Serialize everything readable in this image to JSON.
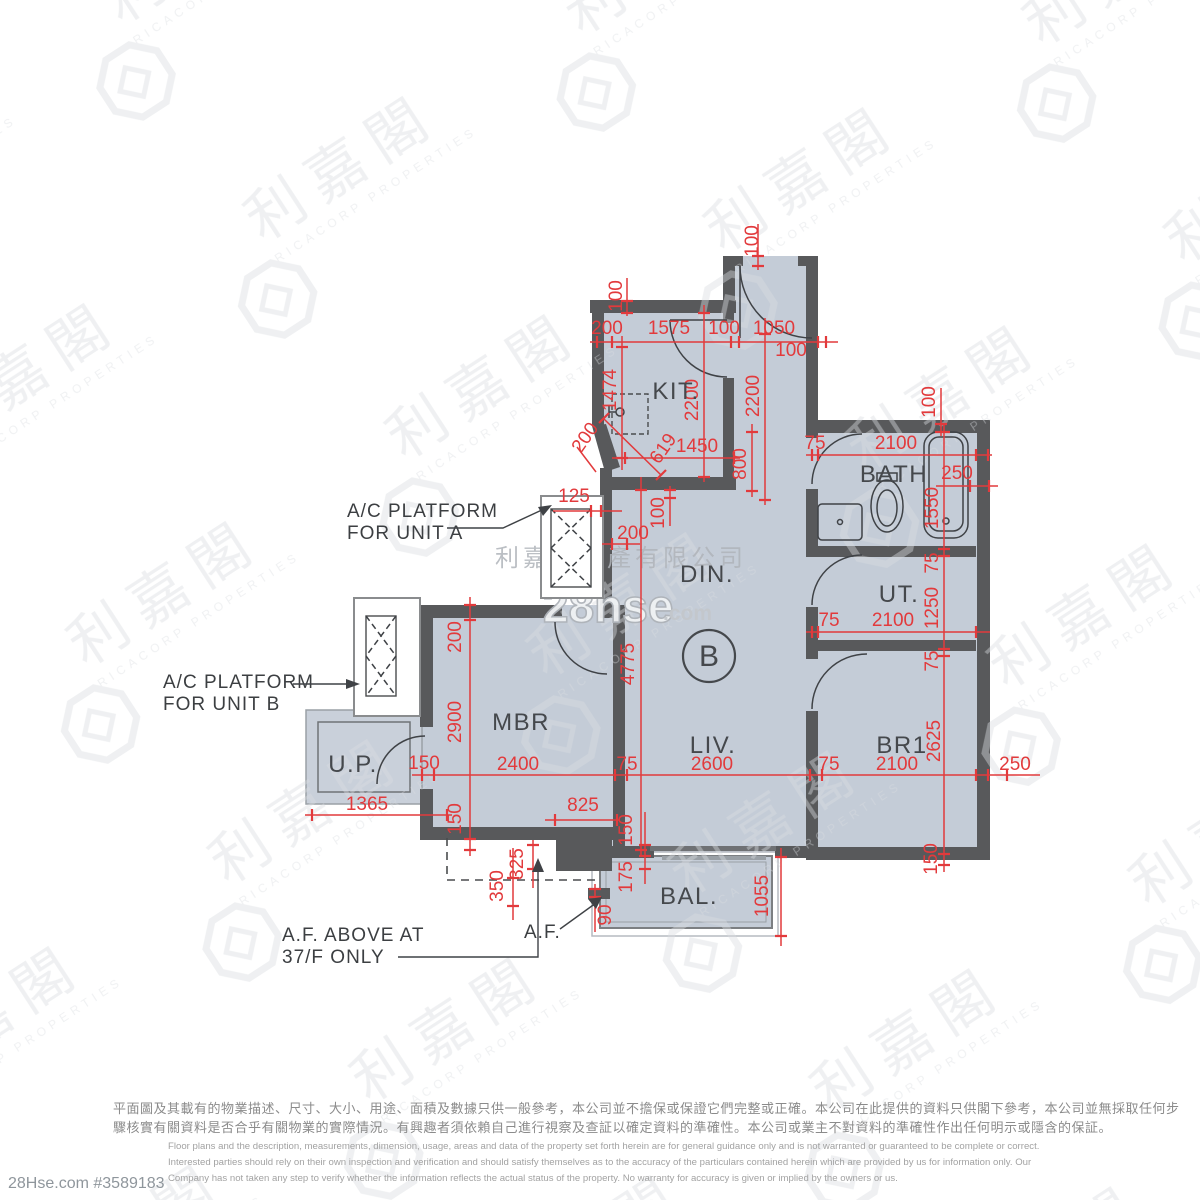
{
  "watermark": {
    "brand_cn": "利嘉閣",
    "brand_en": "RICACORP PROPERTIES",
    "company_cn": "利嘉閣地產有限公司",
    "hse_main": "28hse",
    "hse_suffix": ".com",
    "listing_ref": "28Hse.com #3589183"
  },
  "plan": {
    "unit": "B",
    "rooms": {
      "kit": "KIT.",
      "bath": "BATH",
      "din": "DIN.",
      "ut": "UT.",
      "mbr": "MBR",
      "liv": "LIV.",
      "br1": "BR1",
      "up": "U.P.",
      "bal": "BAL."
    },
    "annotations": {
      "ac_a_line1": "A/C PLATFORM",
      "ac_a_line2": "FOR UNIT A",
      "ac_b_line1": "A/C PLATFORM",
      "ac_b_line2": "FOR UNIT B",
      "af_above_line1": "A.F. ABOVE AT",
      "af_above_line2": "37/F ONLY",
      "af": "A.F."
    },
    "dims": {
      "d01": "100",
      "d02": "100",
      "d03": "200",
      "d04": "1575",
      "d05": "100",
      "d06": "1050",
      "d07": "100",
      "d08": "1474",
      "d09": "2200",
      "d10": "2200",
      "d11": "800",
      "d12": "619",
      "d13": "1450",
      "d14": "200",
      "d15": "125",
      "d16": "200",
      "d17": "100",
      "d18": "75",
      "d19": "2100",
      "d20": "100",
      "d21": "250",
      "d22": "1550",
      "d23": "75",
      "d24": "1250",
      "d25": "75",
      "d26": "75",
      "d27": "2100",
      "d28": "4775",
      "d29": "200",
      "d30": "2900",
      "d31": "2625",
      "d32": "150",
      "d33": "2400",
      "d34": "75",
      "d35": "2600",
      "d36": "75",
      "d37": "2100",
      "d38": "250",
      "d39": "1365",
      "d40": "150",
      "d41": "825",
      "d42": "150",
      "d43": "175",
      "d44": "325",
      "d45": "350",
      "d46": "90",
      "d47": "1055",
      "d48": "150"
    }
  },
  "disclaimer": {
    "zh1": "平面圖及其載有的物業描述、尺寸、大小、用途、面積及數據只供一般參考，本公司並不擔保或保證它們完整或正確。本公司在此提供的資料只供閣下參考，本公司並無採取任何步",
    "zh2": "驟核實有關資料是否合乎有關物業的實際情況。有興趣者須依賴自己進行視察及查証以確定資料的準確性。本公司或業主不對資料的準確性作出任何明示或隱含的保証。",
    "en1": "Floor plans and the description, measurements, dimension, usage, areas and data of the property set forth herein are for general guidance only and is not warranted or guaranteed to be complete or correct.",
    "en2": "Interested parties should rely on their own inspection and verification and should satisfy themselves as to the accuracy of the particulars contained herein which are provided by us for information only.  Our",
    "en3": "Company has not taken any step to verify whether the information reflects the actual status of the property.  No warranty for accuracy is given or implied by the owners or us."
  }
}
